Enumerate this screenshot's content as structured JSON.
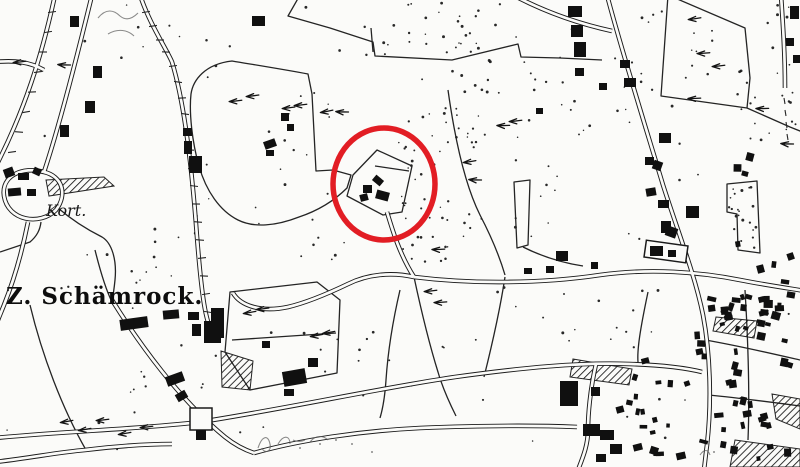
{
  "map": {
    "labels": {
      "kort": "Kort.",
      "schamrock": "Z. Schämrock."
    },
    "annotation": {
      "shape": "ellipse",
      "color": "#e21d24",
      "cx": 384,
      "cy": 184,
      "rx": 51,
      "ry": 56,
      "stroke_width": 5.5
    },
    "palette": {
      "paper": "#fbfbf9",
      "ink": "#1e1e1e"
    }
  }
}
